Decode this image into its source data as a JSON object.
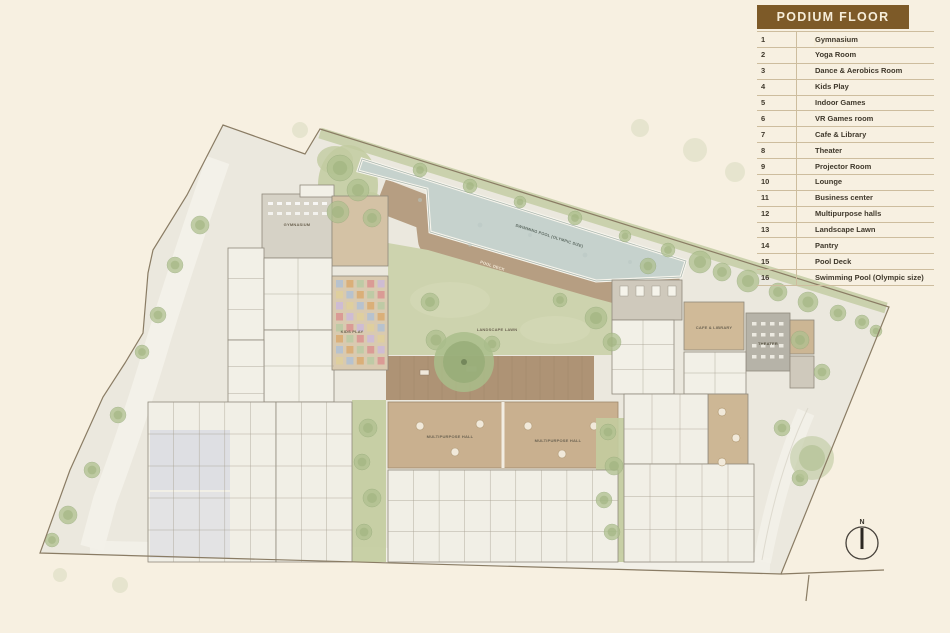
{
  "window": {
    "width": 950,
    "height": 633,
    "background": "#f7f0e1"
  },
  "legend": {
    "title": "PODIUM FLOOR PLAN",
    "items": [
      {
        "num": "1",
        "label": "Gymnasium"
      },
      {
        "num": "2",
        "label": "Yoga Room"
      },
      {
        "num": "3",
        "label": "Dance & Aerobics Room"
      },
      {
        "num": "4",
        "label": "Kids Play"
      },
      {
        "num": "5",
        "label": "Indoor Games"
      },
      {
        "num": "6",
        "label": "VR Games room"
      },
      {
        "num": "7",
        "label": "Cafe & Library"
      },
      {
        "num": "8",
        "label": "Theater"
      },
      {
        "num": "9",
        "label": "Projector Room"
      },
      {
        "num": "10",
        "label": "Lounge"
      },
      {
        "num": "11",
        "label": "Business center"
      },
      {
        "num": "12",
        "label": "Multipurpose halls"
      },
      {
        "num": "13",
        "label": "Landscape Lawn"
      },
      {
        "num": "14",
        "label": "Pantry"
      },
      {
        "num": "15",
        "label": "Pool Deck"
      },
      {
        "num": "16",
        "label": "Swimming Pool (Olympic size)"
      }
    ]
  },
  "plan": {
    "north_label": "N",
    "labels": {
      "gymnasium": "GYMNASIUM",
      "kids_play": "KIDS PLAY",
      "landscape_lawn": "LANDSCAPE LAWN",
      "multipurpose_hall_a": "MULTIPURPOSE HALL",
      "multipurpose_hall_b": "MULTIPURPOSE HALL",
      "pool_deck": "POOL DECK",
      "swimming_pool": "SWIMMING POOL (OLYMPIC SIZE)",
      "cafe_library": "CAFE & LIBRARY",
      "theater": "THEATER"
    },
    "colors": {
      "site_fill": "#ebe8de",
      "boundary_line": "#8a7c64",
      "pool_water": "#c6d2cd",
      "pool_deck_wood": "#b09678",
      "lawn_green": "#cdd3ae",
      "tree_green": "#afc08f",
      "building_white": "#f2f0e7",
      "building_gray": "#d6d2c6",
      "building_tan": "#d4c2a5",
      "theater_gray": "#b6b3a8",
      "kids_play_base": "#d9cab0",
      "legend_title_bg": "#7d5a28",
      "legend_title_text": "#f6edd9",
      "legend_text": "#3f382b",
      "legend_divider": "#cdbd9e"
    }
  }
}
